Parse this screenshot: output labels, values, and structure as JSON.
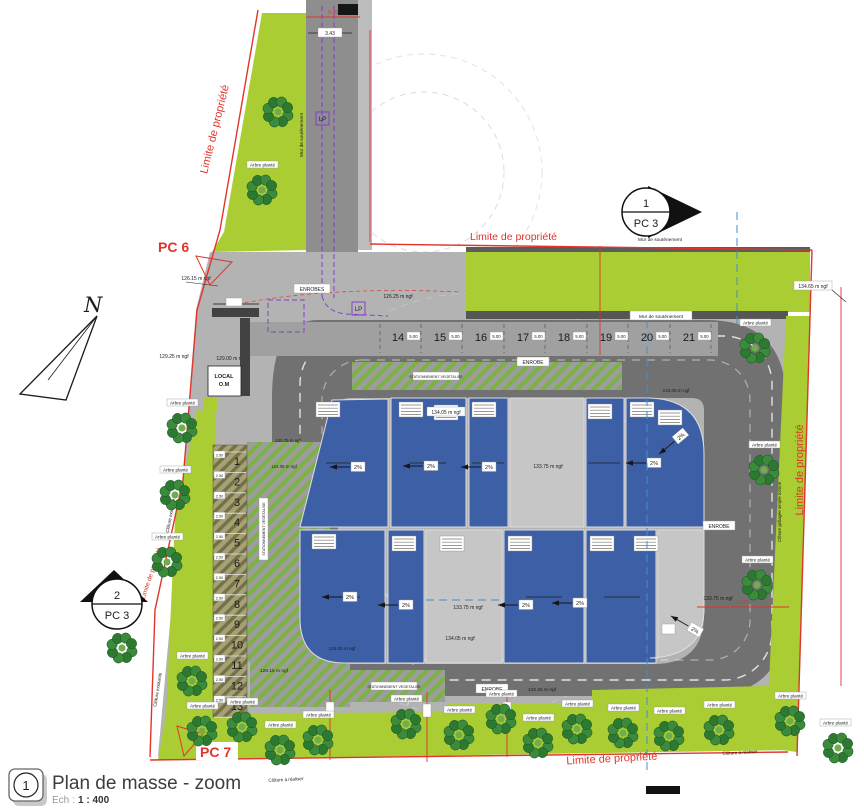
{
  "title_block": {
    "index": "1",
    "title": "Plan de masse - zoom",
    "scale_prefix": "Ech :",
    "scale_value": "1 : 400"
  },
  "compass": {
    "north": "N"
  },
  "boundary": {
    "label": "Limite de propriété"
  },
  "markers": {
    "pc6": "PC 6",
    "pc7": "PC 7",
    "pc3_top_num": "1",
    "pc3_top": "PC 3",
    "pc3_left_num": "2",
    "pc3_left": "PC 3"
  },
  "surfaces": {
    "enrobe": "ENROBE",
    "enrobes": "ENROBES",
    "stationnement": "STATIONNEMENT VEGETALISE",
    "local_line1": "LOCAL",
    "local_line2": "O.M"
  },
  "structures": {
    "mur": "Mur de soutènement",
    "cloture_existante": "Clôture existante",
    "cloture_grillagee": "Clôture grillagée simple torsion",
    "cloture_a_realiser": "Clôture à réaliser"
  },
  "vegetation": {
    "arbre": "Arbre planté"
  },
  "elevations": {
    "e123_75": "123.75 m ngf",
    "e124_05": "124.05 m ngf",
    "e126_15": "126.15 m ngf",
    "e126_25": "126.25 m ngf",
    "e129_00": "129.00 m ngf",
    "e129_25": "129.25 m ngf",
    "e133_75": "133.75 m ngf",
    "e134_05": "134.05 m ngf",
    "e134_65": "134.65 m ngf"
  },
  "dimensions": {
    "d_545": "5.45",
    "d_343": "3.43",
    "d_500": "5.00",
    "d_250": "2.50",
    "d_1175": "11.75",
    "slope": "2%",
    "lp": "LP"
  },
  "parking": {
    "left_numbers": [
      "1",
      "2",
      "3",
      "4",
      "5",
      "6",
      "7",
      "8",
      "9",
      "10",
      "11",
      "12",
      "13"
    ],
    "top_numbers": [
      "14",
      "15",
      "16",
      "17",
      "18",
      "19",
      "20",
      "21"
    ]
  }
}
